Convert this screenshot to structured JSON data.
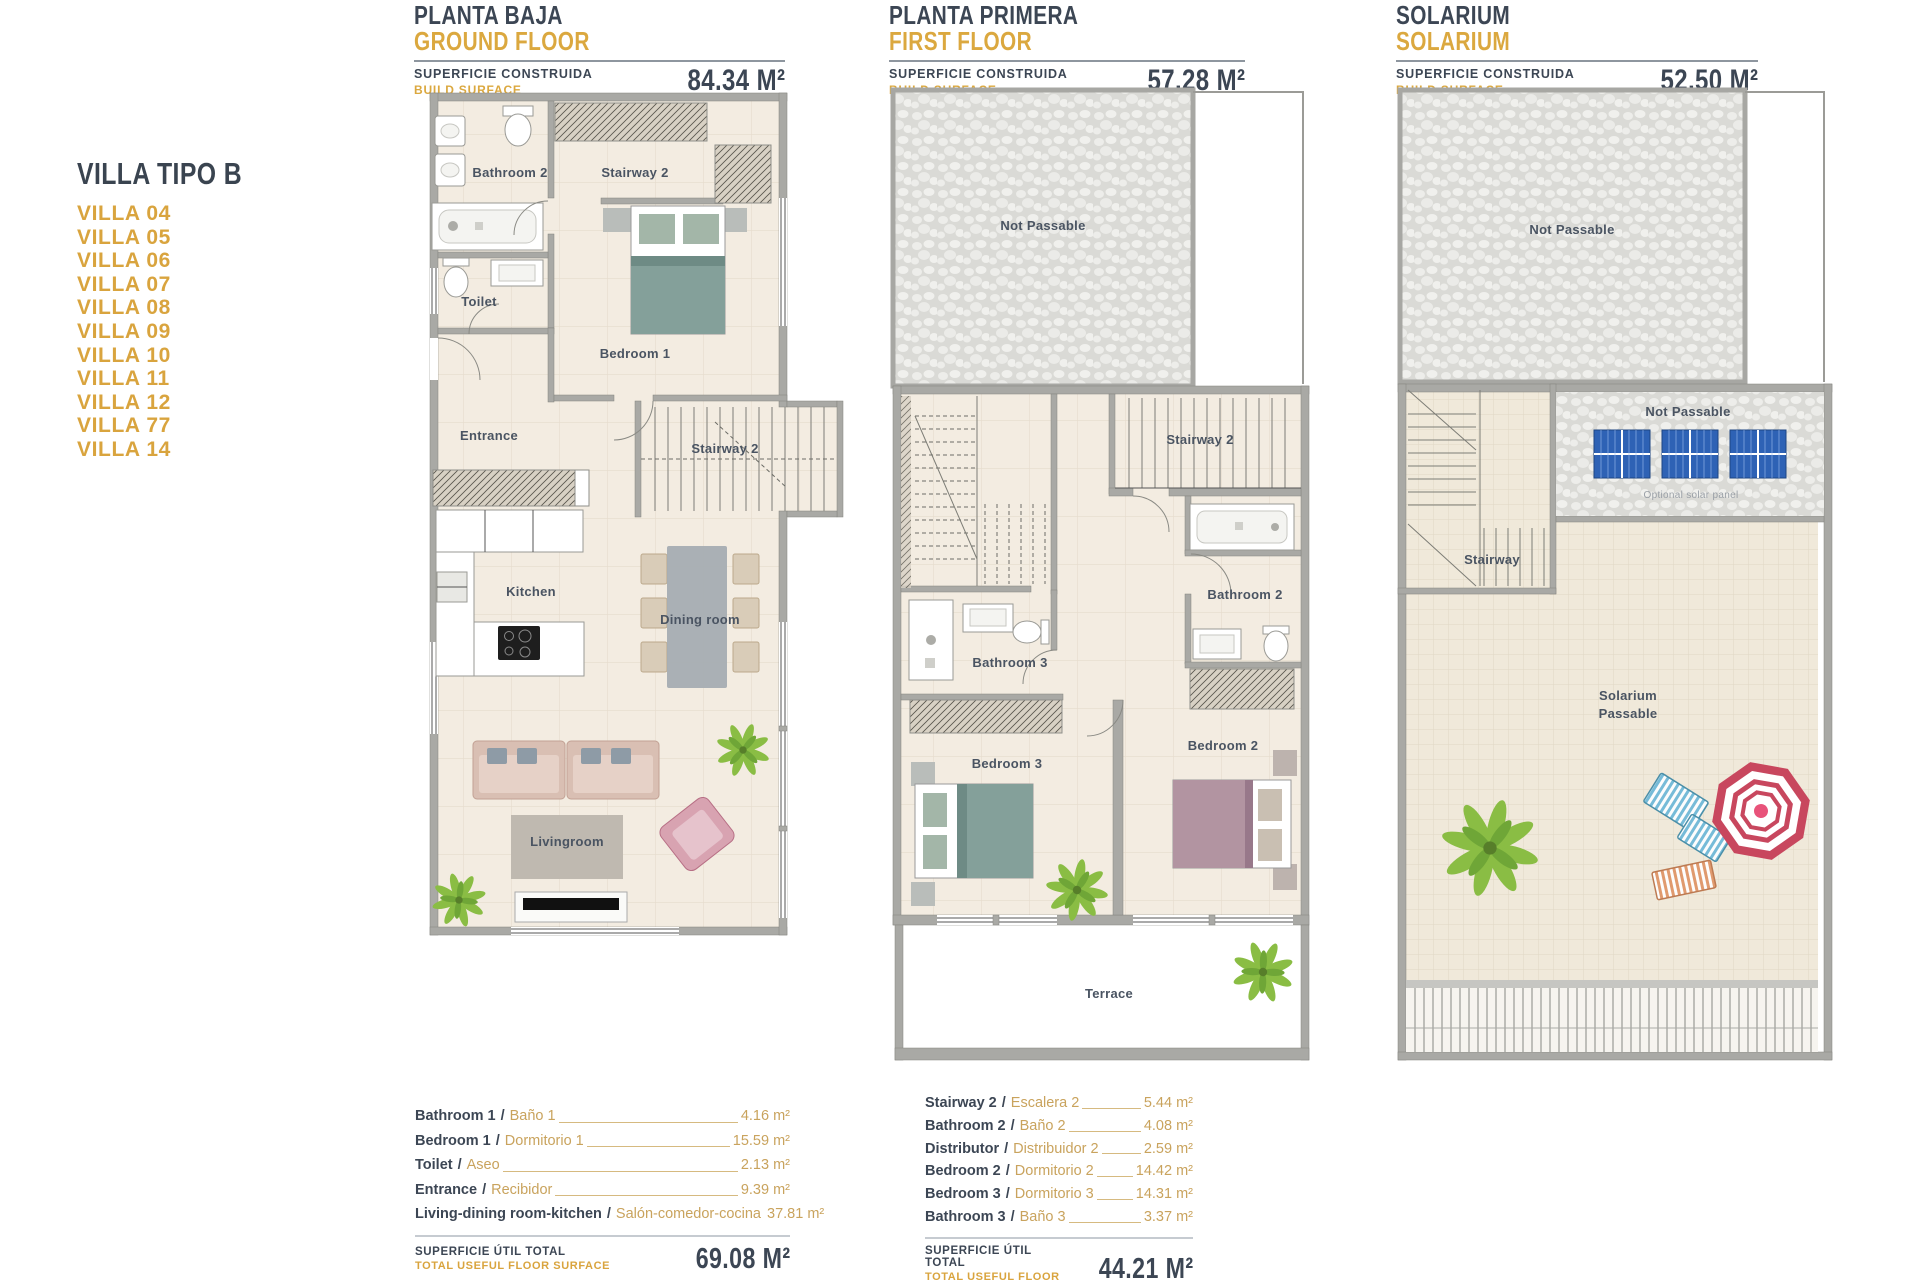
{
  "sidebar": {
    "title": "VILLA TIPO B",
    "items": [
      "VILLA 04",
      "VILLA 05",
      "VILLA 06",
      "VILLA 07",
      "VILLA 08",
      "VILLA 09",
      "VILLA 10",
      "VILLA 11",
      "VILLA 12",
      "VILLA 77",
      "VILLA 14"
    ]
  },
  "panels": {
    "ground": {
      "title_line1": "PLANTA BAJA",
      "title_line2": "GROUND FLOOR",
      "surface_label1": "SUPERFICIE CONSTRUIDA",
      "surface_label2": "BUILD SURFACE",
      "surface_value": "84.34 M²"
    },
    "first": {
      "title_line1": "PLANTA PRIMERA",
      "title_line2": "FIRST FLOOR",
      "surface_label1": "SUPERFICIE CONSTRUIDA",
      "surface_label2": "BUILD SURFACE",
      "surface_value": "57.28 M²"
    },
    "solarium": {
      "title_line1": "SOLARIUM",
      "title_line2": "SOLARIUM",
      "surface_label1": "SUPERFICIE CONSTRUIDA",
      "surface_label2": "BUILD SURFACE",
      "surface_value": "52,50 M²"
    }
  },
  "ground_plan": {
    "bathroom2": "Bathroom 2",
    "stairway2_upper": "Stairway 2",
    "toilet": "Toilet",
    "bedroom1": "Bedroom 1",
    "entrance": "Entrance",
    "stairway2": "Stairway 2",
    "kitchen": "Kitchen",
    "dining": "Dining room",
    "livingroom": "Livingroom"
  },
  "first_plan": {
    "not_passable": "Not Passable",
    "stairway2": "Stairway 2",
    "bathroom2": "Bathroom 2",
    "bathroom3": "Bathroom 3",
    "bedroom3": "Bedroom 3",
    "bedroom2": "Bedroom 2",
    "terrace": "Terrace"
  },
  "solarium_plan": {
    "not_passable_top": "Not Passable",
    "not_passable_panels": "Not Passable",
    "optional_solar": "Optional solar panel",
    "stairway": "Stairway",
    "label_line1": "Solarium",
    "label_line2": "Passable"
  },
  "ground_table": {
    "sep": "/",
    "rows": [
      {
        "en": "Bathroom 1",
        "es": "Baño 1",
        "value": "4.16 m²"
      },
      {
        "en": "Bedroom 1",
        "es": "Dormitorio 1",
        "value": "15.59 m²"
      },
      {
        "en": "Toilet",
        "es": "Aseo",
        "value": "2.13 m²"
      },
      {
        "en": "Entrance",
        "es": "Recibidor",
        "value": "9.39 m²"
      },
      {
        "en": "Living-dining room-kitchen",
        "es": "Salón-comedor-cocina",
        "value": "37.81 m²"
      }
    ],
    "total_label1": "SUPERFICIE ÚTIL TOTAL",
    "total_label2": "TOTAL USEFUL FLOOR SURFACE",
    "total_value": "69.08 M²"
  },
  "first_table": {
    "sep": "/",
    "rows": [
      {
        "en": "Stairway 2",
        "es": "Escalera 2",
        "value": "5.44 m²"
      },
      {
        "en": "Bathroom 2",
        "es": "Baño 2",
        "value": "4.08 m²"
      },
      {
        "en": "Distributor",
        "es": "Distribuidor 2",
        "value": "2.59 m²"
      },
      {
        "en": "Bedroom 2",
        "es": "Dormitorio 2",
        "value": "14.42 m²"
      },
      {
        "en": "Bedroom 3",
        "es": "Dormitorio 3",
        "value": "14.31 m²"
      },
      {
        "en": "Bathroom 3",
        "es": "Baño 3",
        "value": "3.37 m²"
      }
    ],
    "total_label1": "SUPERFICIE ÚTIL TOTAL",
    "total_label2": "TOTAL USEFUL FLOOR SURFACE",
    "total_value": "44.21 M²"
  },
  "colors": {
    "dark": "#3C4654",
    "gold": "#D9A43E",
    "wall": "#A9A9A5",
    "floor": "#F3ECE1",
    "solar_blue": "#2E62B5",
    "umbrella_red": "#C8475E"
  }
}
